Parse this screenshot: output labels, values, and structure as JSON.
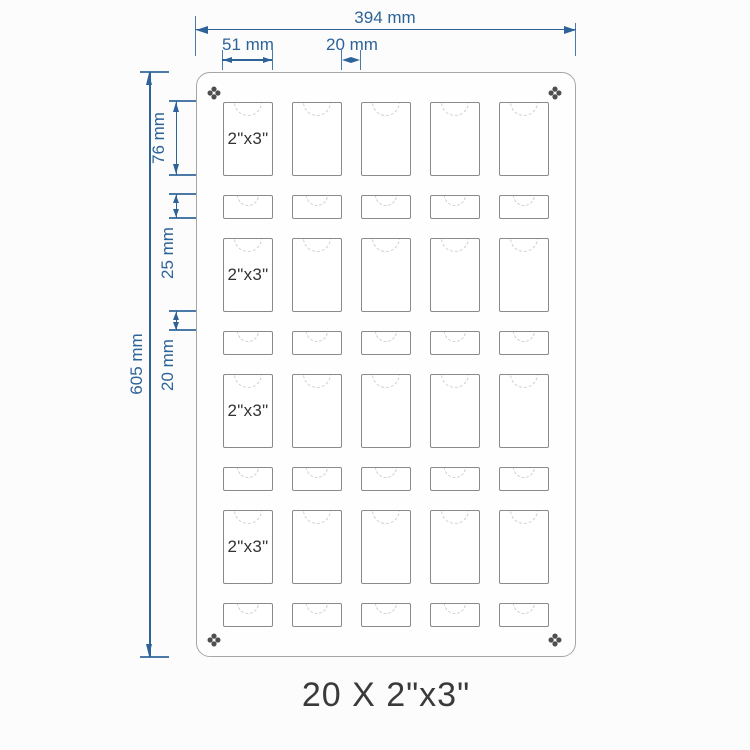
{
  "caption": "20 X 2\"x3\"",
  "slot_label": "2\"x3\"",
  "dimensions": {
    "total_width": "394 mm",
    "slot_width": "51 mm",
    "column_gap": "20 mm",
    "total_height": "605 mm",
    "large_slot_height": "76 mm",
    "small_slot_height": "25 mm",
    "row_gap": "20 mm"
  },
  "grid": {
    "columns": 5,
    "large_rows": 4,
    "small_rows": 4,
    "labeled_column": 0
  },
  "icons": {
    "corner_fastener": "phillips-screw-icon",
    "slot_cutout": "dashed-thumb-notch-arc"
  },
  "colors": {
    "dimension": "#2d6399",
    "panel_border": "#a6a6a6",
    "panel_fill": "#fefefe",
    "slot_border": "#8a8a8a",
    "notch": "#cdcdcd",
    "slot_label": "#333333",
    "caption": "#3a3a3a",
    "screw": "#4f4f4f",
    "background": "#fcfcfc"
  }
}
